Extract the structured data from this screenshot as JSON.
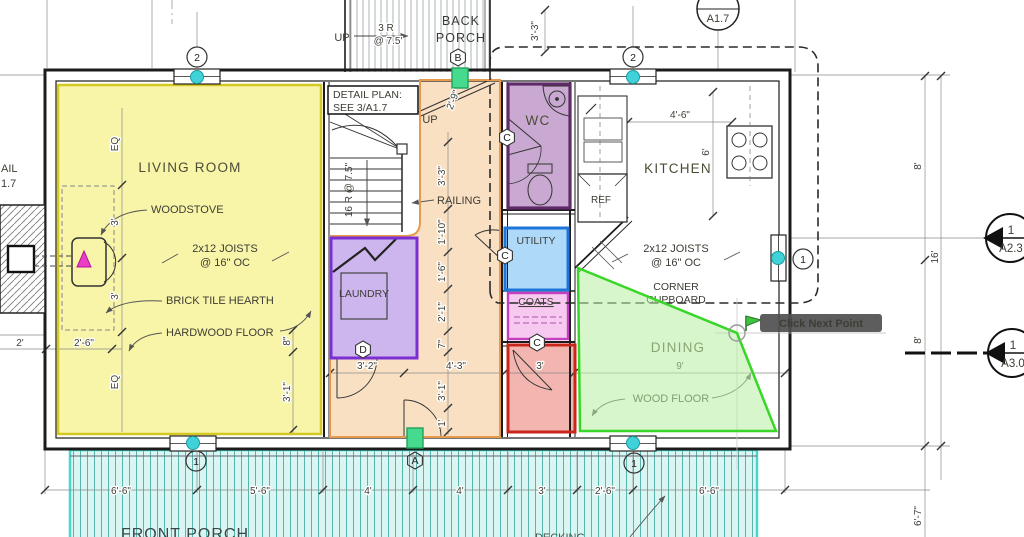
{
  "colors": {
    "living_fill": "#f8f4a8",
    "living_stroke": "#d6c822",
    "hall_fill": "#fae0c3",
    "hall_stroke": "#e79a4e",
    "wc_fill": "#c9a9d2",
    "wc_stroke": "#5f2a68",
    "laundry_fill": "#cdb6ed",
    "laundry_stroke": "#7b2fd2",
    "utility_fill": "#aed9f9",
    "utility_stroke": "#1f76d9",
    "coats_fill": "#f8c9f0",
    "coats_stroke": "#c43fc0",
    "entry_fill": "#f2b5af",
    "entry_stroke": "#c9261b",
    "dining_fill": "#b7eea3",
    "dining_stroke": "#38d626",
    "porch_fill": "#daf6f2",
    "porch_hatch": "#58b4ac",
    "porch_stroke": "#49d7cd",
    "backporch_hatch": "#9aa0a0",
    "window_dot": "#3fd3d9",
    "door_marker": "#45da8e",
    "door_marker_stroke": "#23a05e",
    "stove_triangle": "#ea3fc5",
    "flag_green": "#3ec43e",
    "tooltip_bg": "#4f4f4f",
    "tooltip_text": "#ffffff"
  },
  "tooltip": {
    "label": "Click Next Point"
  },
  "rooms": {
    "living": "LIVING ROOM",
    "wc": "WC",
    "kitchen": "KITCHEN",
    "laundry": "LAUNDRY",
    "utility": "UTILITY",
    "coats": "COATS",
    "dining": "DINING",
    "back_porch_line1": "BACK",
    "back_porch_line2": "PORCH",
    "front_porch": "FRONT PORCH"
  },
  "annotations": {
    "woodstove": "WOODSTOVE",
    "joists_line1": "2x12 JOISTS",
    "joists_line2": "@ 16\" OC",
    "brick_hearth": "BRICK TILE HEARTH",
    "hardwood_floor": "HARDWOOD FLOOR",
    "railing": "RAILING",
    "detail_line1": "DETAIL PLAN:",
    "detail_line2": "SEE 3/A1.7",
    "up_stair": "UP",
    "stair_risers": "16 R @ 7.5\"",
    "up_back_porch": "UP",
    "back_risers_line1": "3 R",
    "back_risers_line2": "@ 7.5'",
    "ref": "REF",
    "corner_line1": "CORNER",
    "corner_line2": "CUPBOARD",
    "wood_floor": "WOOD FLOOR",
    "decking": "DECKING"
  },
  "markers": {
    "window_top_left": "2",
    "window_top_right": "2",
    "window_bottom_left": "1",
    "window_bottom_right": "1",
    "window_right": "1",
    "hex_back_door": "B",
    "hex_front_door": "A",
    "hex_wc_door": "C",
    "hex_utility_door": "C",
    "hex_entry_door": "C",
    "hex_laundry_door": "D",
    "detail_bubble": "A1.7",
    "section_right_num": "1",
    "section_right_sheet": "A2.3",
    "section_lower_num": "1",
    "section_lower_sheet": "A3.0",
    "left_edge_cut_line1": "AIL",
    "left_edge_cut_line2": "1.7"
  },
  "dims": {
    "bottom": [
      "6'-6\"",
      "5'-6\"",
      "4'",
      "4'",
      "3'",
      "2'-6\"",
      "6'-6\""
    ],
    "right": [
      "8'",
      "16'",
      "8'",
      "6'-7\""
    ],
    "hall": [
      "2'-9\"",
      "3'-3\"",
      "1'-10\"",
      "1'-6\"",
      "2'-1\"",
      "7\"",
      "3'-1\"",
      "1'"
    ],
    "middle": [
      "3'-2\"",
      "4'-3\"",
      "3'",
      "9'"
    ],
    "living_center": [
      "EQ",
      "3'",
      "3'",
      "EQ"
    ],
    "living_right": [
      "8\"",
      "3'-1\""
    ],
    "living_bottom": [
      "2'",
      "2'-6\""
    ],
    "kitchen": [
      "4'-6\"",
      "6'"
    ],
    "back_porch": [
      "3'-3\""
    ]
  }
}
